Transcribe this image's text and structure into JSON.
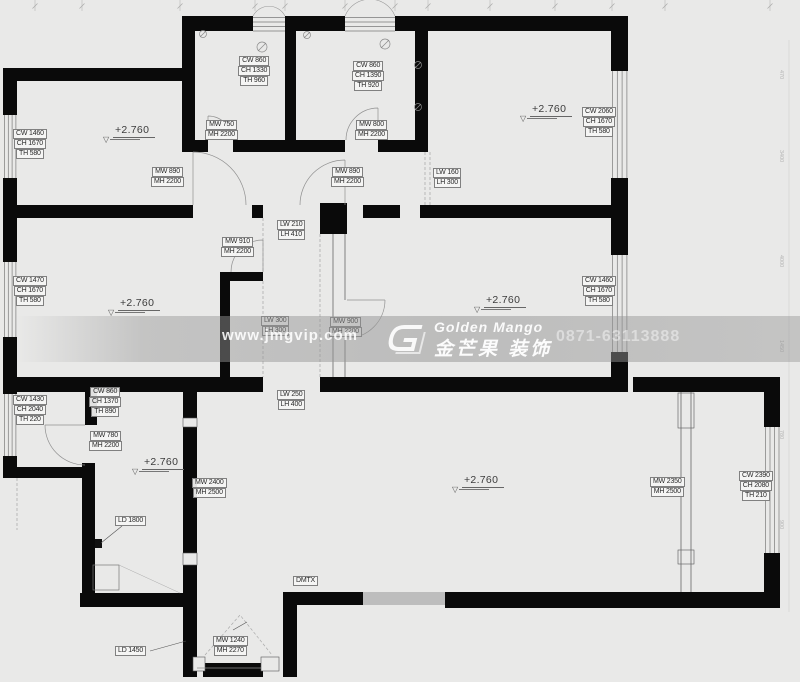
{
  "page": {
    "background": "#e9e9e8",
    "wall_color": "#0a0a0a",
    "band_color": "rgba(150,150,150,0.5)"
  },
  "watermark": {
    "website": "www.jmgvip.com",
    "brand_en": "Golden Mango",
    "brand_cn": "金芒果 装饰",
    "phone": "0871-63113888",
    "logo": "golden-mango-logo"
  },
  "levels": [
    {
      "x": 103,
      "y": 120,
      "text": "+2.760"
    },
    {
      "x": 520,
      "y": 99,
      "text": "+2.760"
    },
    {
      "x": 108,
      "y": 293,
      "text": "+2.760"
    },
    {
      "x": 474,
      "y": 290,
      "text": "+2.760"
    },
    {
      "x": 132,
      "y": 452,
      "text": "+2.760"
    },
    {
      "x": 452,
      "y": 470,
      "text": "+2.760"
    }
  ],
  "labels": [
    {
      "x": 238,
      "y": 56,
      "lines": [
        "CW 860",
        "CH 1330",
        "TH 960"
      ]
    },
    {
      "x": 352,
      "y": 61,
      "lines": [
        "CW 860",
        "CH 1390",
        "TH 920"
      ]
    },
    {
      "x": 582,
      "y": 107,
      "lines": [
        "CW 2060",
        "CH 1670",
        "TH 580"
      ]
    },
    {
      "x": 13,
      "y": 129,
      "lines": [
        "CW 1460",
        "CH 1670",
        "TH 580"
      ]
    },
    {
      "x": 205,
      "y": 120,
      "lines": [
        "MW 750",
        "MH 2200"
      ]
    },
    {
      "x": 355,
      "y": 120,
      "lines": [
        "MW 800",
        "MH 2200"
      ]
    },
    {
      "x": 151,
      "y": 167,
      "lines": [
        "MW 890",
        "MH 2200"
      ]
    },
    {
      "x": 331,
      "y": 167,
      "lines": [
        "MW 890",
        "MH 2200"
      ]
    },
    {
      "x": 433,
      "y": 168,
      "lines": [
        "LW 160",
        "LH 300"
      ]
    },
    {
      "x": 277,
      "y": 220,
      "lines": [
        "LW 210",
        "LH 410"
      ]
    },
    {
      "x": 221,
      "y": 237,
      "lines": [
        "MW 910",
        "MH 2200"
      ]
    },
    {
      "x": 13,
      "y": 276,
      "lines": [
        "CW 1470",
        "CH 1670",
        "TH 580"
      ]
    },
    {
      "x": 582,
      "y": 276,
      "lines": [
        "CW 1460",
        "CH 1670",
        "TH 580"
      ]
    },
    {
      "x": 261,
      "y": 316,
      "lines": [
        "LW 300",
        "LH 300"
      ]
    },
    {
      "x": 329,
      "y": 317,
      "lines": [
        "MW 900",
        "MH 2200"
      ]
    },
    {
      "x": 277,
      "y": 390,
      "lines": [
        "LW 250",
        "LH 400"
      ]
    },
    {
      "x": 13,
      "y": 395,
      "lines": [
        "CW 1430",
        "CH 2040",
        "TH 220"
      ]
    },
    {
      "x": 89,
      "y": 387,
      "lines": [
        "CW 860",
        "CH 1370",
        "TH 890"
      ]
    },
    {
      "x": 89,
      "y": 431,
      "lines": [
        "MW 780",
        "MH 2200"
      ]
    },
    {
      "x": 192,
      "y": 478,
      "lines": [
        "MW 2400",
        "MH 2500"
      ]
    },
    {
      "x": 650,
      "y": 477,
      "lines": [
        "MW 2350",
        "MH 2500"
      ]
    },
    {
      "x": 739,
      "y": 471,
      "lines": [
        "CW 2390",
        "CH 2080",
        "TH 210"
      ]
    },
    {
      "x": 115,
      "y": 516,
      "lines": [
        "LD 1800"
      ]
    },
    {
      "x": 115,
      "y": 646,
      "lines": [
        "LD 1450"
      ]
    },
    {
      "x": 213,
      "y": 636,
      "lines": [
        "MW 1240",
        "MH 2270"
      ]
    },
    {
      "x": 293,
      "y": 576,
      "lines": [
        "DMTX"
      ]
    }
  ],
  "right_dims": [
    {
      "y": 70,
      "text": "470"
    },
    {
      "y": 150,
      "text": "3400"
    },
    {
      "y": 255,
      "text": "4000"
    },
    {
      "y": 340,
      "text": "1450"
    },
    {
      "y": 430,
      "text": "780"
    },
    {
      "y": 520,
      "text": "900"
    }
  ]
}
